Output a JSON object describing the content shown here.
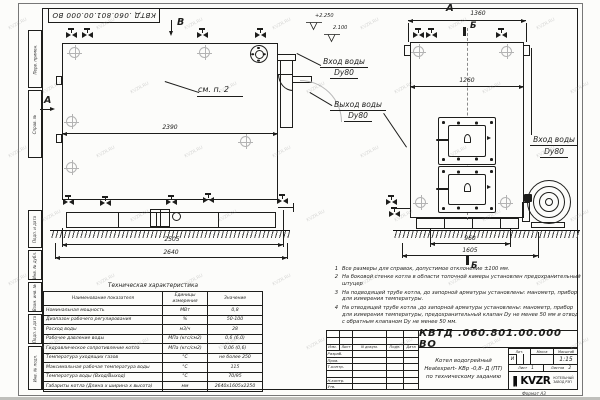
{
  "watermark": "KVZR.RU",
  "stamp": {
    "doc_number_top": "КВТД .060.801.00.000  ВО"
  },
  "frame": {
    "left_labels": [
      "Перв. примен.",
      "Справ. №",
      "Подп. и дата",
      "Инв. № дубл.",
      "Взам. инв. №",
      "Подп. и дата",
      "Инв. № подл."
    ],
    "format_label": "Формат    А3"
  },
  "drawing": {
    "side_view": {
      "view_letter_a": "А",
      "view_letter_b": "В",
      "callout": "см. п. 2",
      "dim_length": "2390",
      "dim_base": "2505",
      "dim_overall": "2640",
      "elevation_upper": "+2.250",
      "elevation_lower": "2.100",
      "inlet_label": "Вход воды",
      "inlet_dn": "Dy80",
      "outlet_label": "Выход воды",
      "outlet_dn": "Dy80"
    },
    "front_view": {
      "view_letter": "А",
      "section_letter_top": "Б",
      "section_letter_bottom": "Б",
      "dim_width": "1360",
      "dim_inner": "1260",
      "dim_base": "960",
      "dim_overall": "1605",
      "inlet_label": "Вход воды",
      "inlet_dn": "Dy80"
    }
  },
  "notes": [
    {
      "num": "1",
      "text": "Все размеры для справок, допустимое отклонение  ±100 мм."
    },
    {
      "num": "2",
      "text": "На боковой стенке котла в области топочной камеры установлен предохранительный штуцер"
    },
    {
      "num": "3",
      "text": "На  подводящей трубе котла, до запорной арматуры установлены: манометр, прибор для измерения температуры."
    },
    {
      "num": "4",
      "text": "На отводящей трубе котла ,до запорной арматуры установлены: манометр, прибор для измерения температуры, предохранительный клапан  Dу не менее  50 мм и отвод с обратным клапаном  Dу не менее 50 мм."
    }
  ],
  "tech_table": {
    "title": "Техническая характеристика",
    "col_name": "Наименование показателя",
    "col_units": "Единицы измерения",
    "col_value": "Значение",
    "rows": [
      {
        "name": "Номинальная мощность",
        "units": "МВт",
        "value": "0,8"
      },
      {
        "name": "Диапазон рабочего регулирования",
        "units": "%",
        "value": "50-100"
      },
      {
        "name": "Расход воды",
        "units": "м3/ч",
        "value": "28"
      },
      {
        "name": "Рабочее давление воды",
        "units": "МПа (кгс/см2)",
        "value": "0,6 (6,0)"
      },
      {
        "name": "Гидравлическое сопротивление котла",
        "units": "МПа (кгс/см2)",
        "value": "0,06 (0,6)"
      },
      {
        "name": "Температура уходящих газов",
        "units": "°С",
        "value": "не более 250"
      },
      {
        "name": "Максимальная рабочая температура воды",
        "units": "°С",
        "value": "115"
      },
      {
        "name": "Температура воды (Вход/Выход)",
        "units": "°С",
        "value": "70/95"
      },
      {
        "name": "Габариты котла (Длина х ширина х высота)",
        "units": "мм",
        "value": "2640х1605х2250"
      }
    ]
  },
  "title_block": {
    "doc_number": "КВТД .060.801.00.000  ВО",
    "rev_headers": [
      "Изм.",
      "Лист",
      "N докум.",
      "Подп.",
      "Дата"
    ],
    "sign_rows": [
      "Разраб.",
      "Пров.",
      "Т.контр.",
      "",
      "Н.контр.",
      "Утв."
    ],
    "title_line1": "Котел водогрейный",
    "title_line2": "Heatexpert- КВр -0,8- Д (ПТ)",
    "title_line3": "по техническому заданию",
    "lit_header": "Лит.",
    "mass_header": "Масса",
    "scale_header": "Масштаб",
    "lit_value": "И",
    "scale_value": "1:15",
    "sheet_label": "Лист",
    "sheet_value": "1",
    "sheets_label": "Листов",
    "sheets_value": "2",
    "company_logo": "KVZR",
    "company_line1": "КОТЕЛЬНЫЙ",
    "company_line2": "ЗАВОД РЭП"
  }
}
